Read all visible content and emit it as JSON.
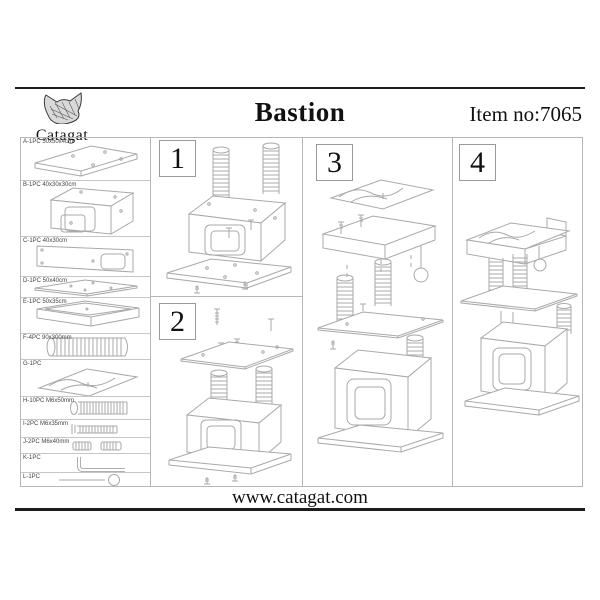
{
  "header": {
    "brand": "Catagat",
    "title": "Bastion",
    "item_no": "Item no:7065"
  },
  "footer": {
    "website": "www.catagat.com"
  },
  "steps": [
    {
      "num": "1"
    },
    {
      "num": "2"
    },
    {
      "num": "3"
    },
    {
      "num": "4"
    }
  ],
  "parts": {
    "items": [
      {
        "label": "A-1PC 50x50x4cm",
        "part": "base-board"
      },
      {
        "label": "B-1PC 40x30x30cm",
        "part": "house-box"
      },
      {
        "label": "C-1PC 40x30cm",
        "part": "side-panel"
      },
      {
        "label": "D-1PC 50x40cm",
        "part": "top-board"
      },
      {
        "label": "E-1PC 50x35cm",
        "part": "bed-tray"
      },
      {
        "label": "F-4PC 90x300mm",
        "part": "scratch-post"
      },
      {
        "label": "G-1PC",
        "part": "plush-cushion"
      },
      {
        "label": "H-10PC M6x50mm",
        "part": "long-bolt"
      },
      {
        "label": "I-2PC M6x35mm",
        "part": "medium-bolt"
      },
      {
        "label": "J-2PC M6x40mm",
        "part": "small-bolts"
      },
      {
        "label": "K-1PC",
        "part": "allen-key"
      },
      {
        "label": "L-1PC",
        "part": "ball-toy"
      }
    ]
  },
  "colors": {
    "line_art": "#a9a9a9",
    "rule": "#1c1c1c",
    "cell_border": "#b7b7b7",
    "text": "#111111"
  }
}
